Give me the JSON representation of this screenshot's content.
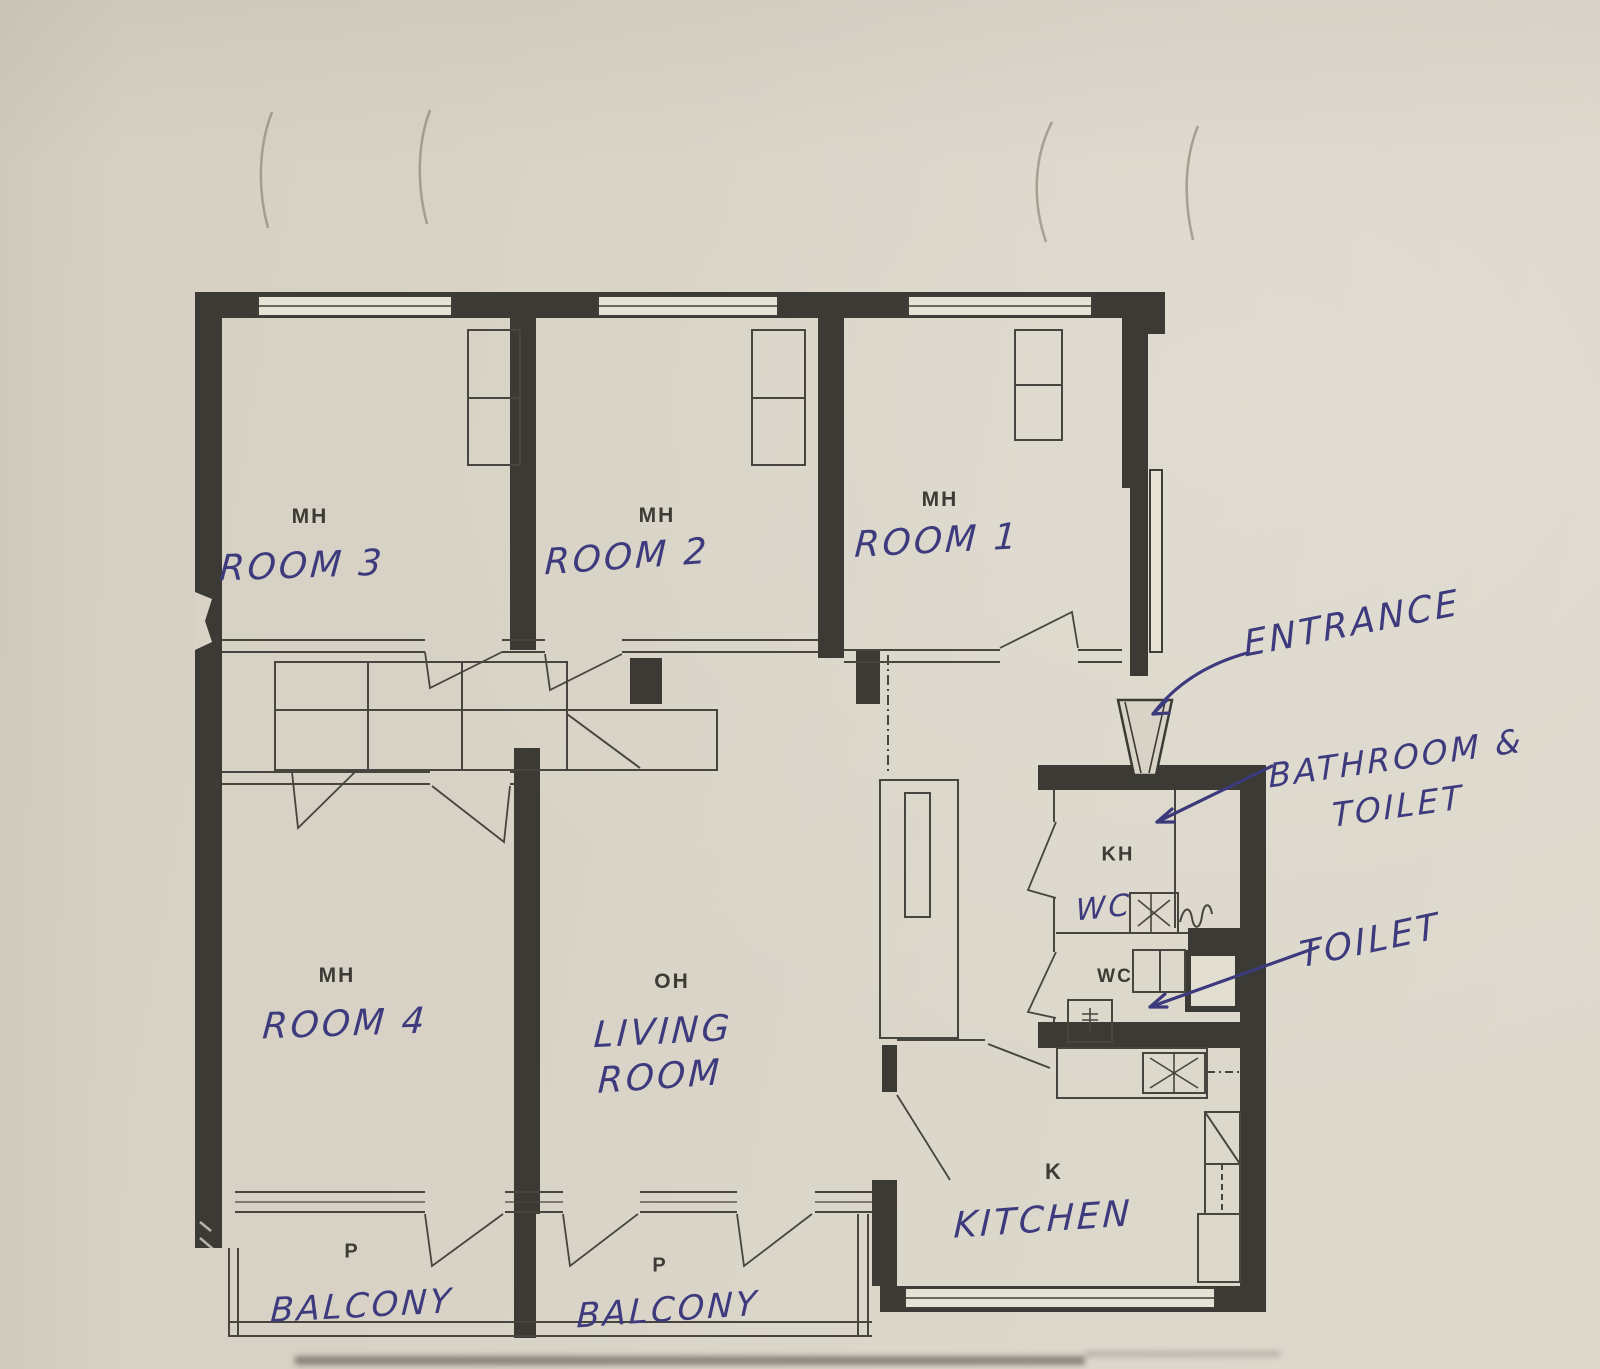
{
  "document": {
    "description": "Photographed apartment floor plan page annotated with blue pen"
  },
  "rooms": {
    "room3": {
      "code": "MH",
      "name": "ROOM 3"
    },
    "room2": {
      "code": "MH",
      "name": "ROOM 2"
    },
    "room1": {
      "code": "MH",
      "name": "ROOM 1"
    },
    "room4": {
      "code": "MH",
      "name": "ROOM 4"
    },
    "living": {
      "code": "OH",
      "name_line1": "LIVING",
      "name_line2": "ROOM"
    },
    "kitchen": {
      "code": "K",
      "name": "KITCHEN"
    },
    "bathroom": {
      "code": "KH",
      "hand_note": "WC"
    },
    "toilet": {
      "code": "WC"
    },
    "balcony_left": {
      "code": "P",
      "name": "BALCONY"
    },
    "balcony_right": {
      "code": "P",
      "name": "BALCONY"
    }
  },
  "callouts": {
    "entrance": "ENTRANCE",
    "bathroom_toilet_line1": "BATHROOM &",
    "bathroom_toilet_line2": "TOILET",
    "toilet": "TOILET"
  },
  "colors": {
    "paper": "#d9d4c7",
    "plan_ink": "#3b3a34",
    "pen": "#3c3a7c"
  }
}
